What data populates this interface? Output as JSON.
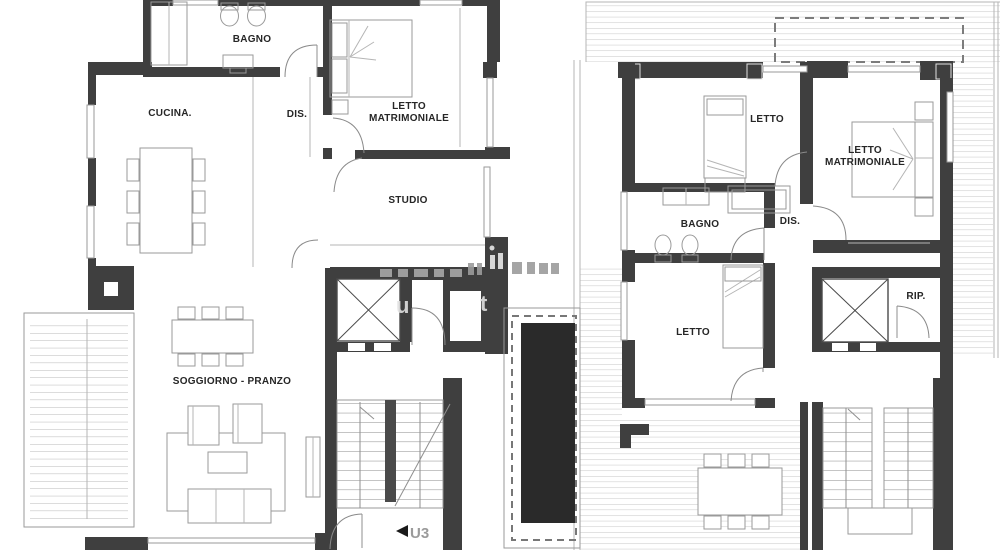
{
  "colors": {
    "background": "#ffffff",
    "wall": "#3f3f3f",
    "thin_line": "#8f8f8f",
    "deck_line": "#c6c6c6",
    "label_text": "#262626",
    "pool_fill": "#2a2a2a",
    "stair_label_text": "#9b9b9b"
  },
  "left_plan": {
    "rooms": {
      "bagno": "BAGNO",
      "cucina": "CUCINA.",
      "dis": "DIS.",
      "letto_matrimoniale_line1": "LETTO",
      "letto_matrimoniale_line2": "MATRIMONIALE",
      "studio": "STUDIO",
      "soggiorno_pranzo": "SOGGIORNO - PRANZO"
    },
    "stair_unit_label": "U3"
  },
  "right_plan": {
    "rooms": {
      "letto_top": "LETTO",
      "letto_matrimoniale_line1": "LETTO",
      "letto_matrimoniale_line2": "MATRIMONIALE",
      "bagno": "BAGNO",
      "dis": "DIS.",
      "letto_bottom": "LETTO",
      "rip": "RIP."
    }
  },
  "watermark": {
    "fragment_u": "u",
    "fragment_t": "t"
  }
}
